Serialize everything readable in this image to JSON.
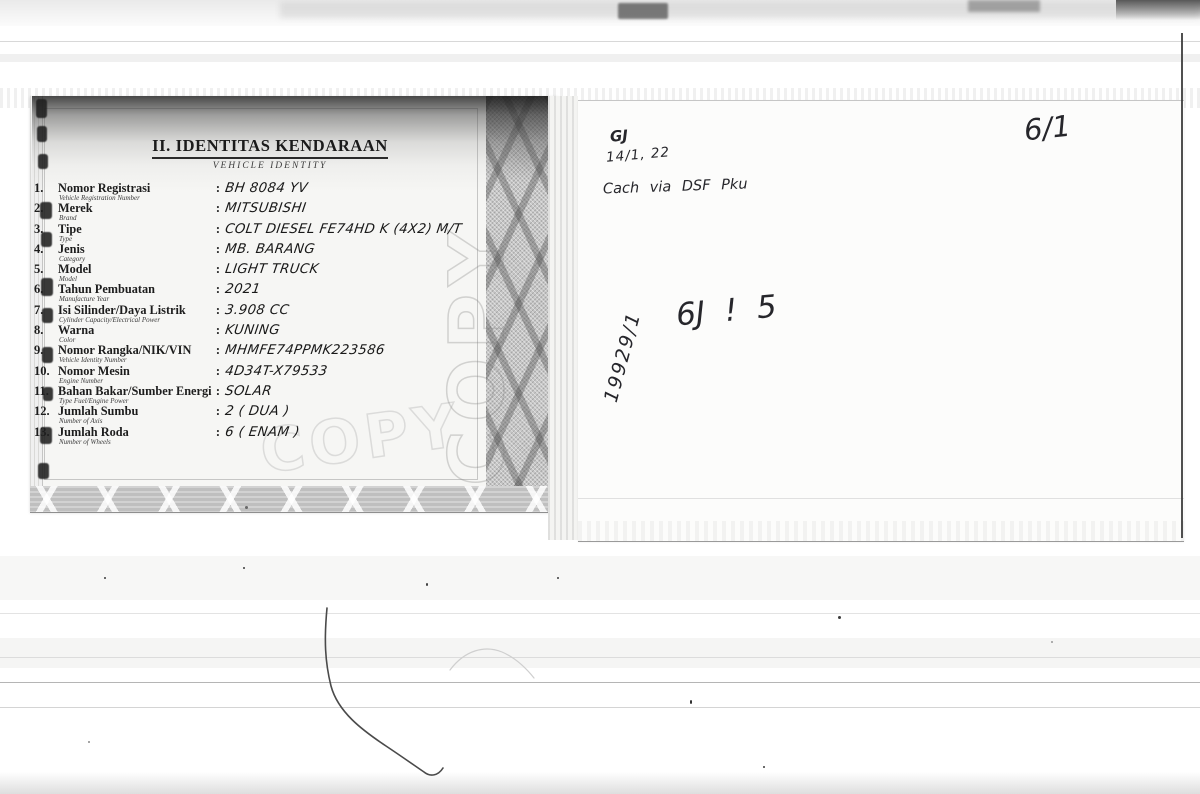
{
  "document": {
    "title": "II. IDENTITAS KENDARAAN",
    "subtitle": "VEHICLE IDENTITY",
    "colon": ":",
    "watermark": "COPY",
    "rows": [
      {
        "num": "1.",
        "label": "Nomor Registrasi",
        "sublabel": "Vehicle Registration Number",
        "value": "BH 8084 YV"
      },
      {
        "num": "2.",
        "label": "Merek",
        "sublabel": "Brand",
        "value": "MITSUBISHI"
      },
      {
        "num": "3.",
        "label": "Tipe",
        "sublabel": "Type",
        "value": "COLT DIESEL FE74HD K (4X2) M/T"
      },
      {
        "num": "4.",
        "label": "Jenis",
        "sublabel": "Category",
        "value": "MB. BARANG"
      },
      {
        "num": "5.",
        "label": "Model",
        "sublabel": "Model",
        "value": "LIGHT TRUCK"
      },
      {
        "num": "6.",
        "label": "Tahun Pembuatan",
        "sublabel": "Manufacture Year",
        "value": "2021"
      },
      {
        "num": "7.",
        "label": "Isi Silinder/Daya Listrik",
        "sublabel": "Cylinder Capacity/Electrical Power",
        "value": "3.908 CC"
      },
      {
        "num": "8.",
        "label": "Warna",
        "sublabel": "Color",
        "value": "KUNING"
      },
      {
        "num": "9.",
        "label": "Nomor Rangka/NIK/VIN",
        "sublabel": "Vehicle Identity Number",
        "value": "MHMFE74PPMK223586"
      },
      {
        "num": "10.",
        "label": "Nomor Mesin",
        "sublabel": "Engine Number",
        "value": "4D34T-X79533"
      },
      {
        "num": "11.",
        "label": "Bahan Bakar/Sumber Energi",
        "sublabel": "Type Fuel/Engine Power",
        "value": "SOLAR"
      },
      {
        "num": "12.",
        "label": "Jumlah Sumbu",
        "sublabel": "Number of Axis",
        "value": "2 ( DUA )"
      },
      {
        "num": "13.",
        "label": "Jumlah Roda",
        "sublabel": "Number of Wheels",
        "value": "6 ( ENAM )"
      }
    ]
  },
  "annotations": {
    "monogram": "GJ",
    "date_note": "14/1, 22",
    "payment_note": "Cach via DSF Pku",
    "page_number": "6/1",
    "center_note": "6J ! 5",
    "vertical_note": "19929/1"
  },
  "colors": {
    "ink": "#1d1d1d",
    "handwriting_ink": "#26262b",
    "watermark_gray": "#dcdcdc",
    "border_gray": "#c6c6c6",
    "paper": "#f6f6f4"
  }
}
